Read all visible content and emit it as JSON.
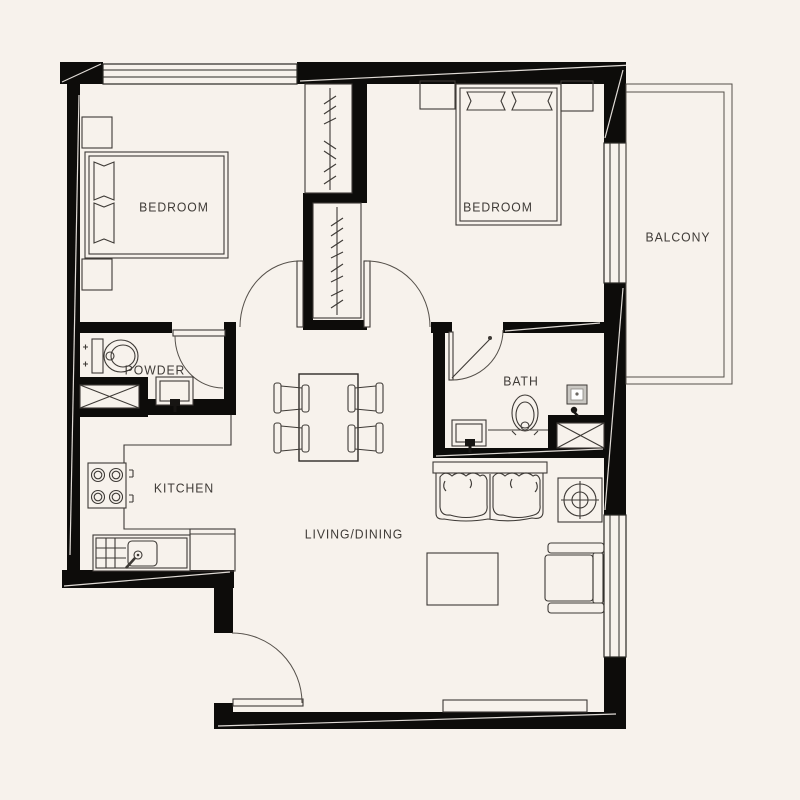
{
  "plan": {
    "type": "apartment-floor-plan",
    "rooms": [
      {
        "id": "bedroom-1",
        "label": "BEDROOM"
      },
      {
        "id": "bedroom-2",
        "label": "BEDROOM"
      },
      {
        "id": "balcony",
        "label": "BALCONY"
      },
      {
        "id": "powder-room",
        "label": "POWDER"
      },
      {
        "id": "bathroom",
        "label": "BATH"
      },
      {
        "id": "kitchen",
        "label": "KITCHEN"
      },
      {
        "id": "living-dining",
        "label": "LIVING/DINING"
      }
    ],
    "colors": {
      "background": "#f7f2ec",
      "wall": "#0d0c0a",
      "line": "#3e3a36",
      "text": "#3f3b37",
      "fixture_gray": "#c9c7c2"
    },
    "fixtures": {
      "bedroom_1": [
        "double-bed",
        "pillows",
        "nightstands",
        "wardrobe",
        "swing-door"
      ],
      "bedroom_2": [
        "double-bed",
        "pillows",
        "nightstands",
        "wardrobe",
        "swing-door"
      ],
      "powder_room": [
        "toilet",
        "washbasin",
        "service-shaft",
        "swing-door"
      ],
      "bathroom": [
        "shower-enclosure",
        "toilet",
        "washbasin",
        "water-heater",
        "service-shaft",
        "swing-door"
      ],
      "kitchen": [
        "cooktop",
        "kitchen-sink",
        "counter",
        "base-cabinet"
      ],
      "living_dining": [
        "dining-table",
        "four-chairs",
        "sofa",
        "coffee-table",
        "armchair",
        "tv-console",
        "side-table",
        "entry-door"
      ],
      "balcony": []
    }
  }
}
